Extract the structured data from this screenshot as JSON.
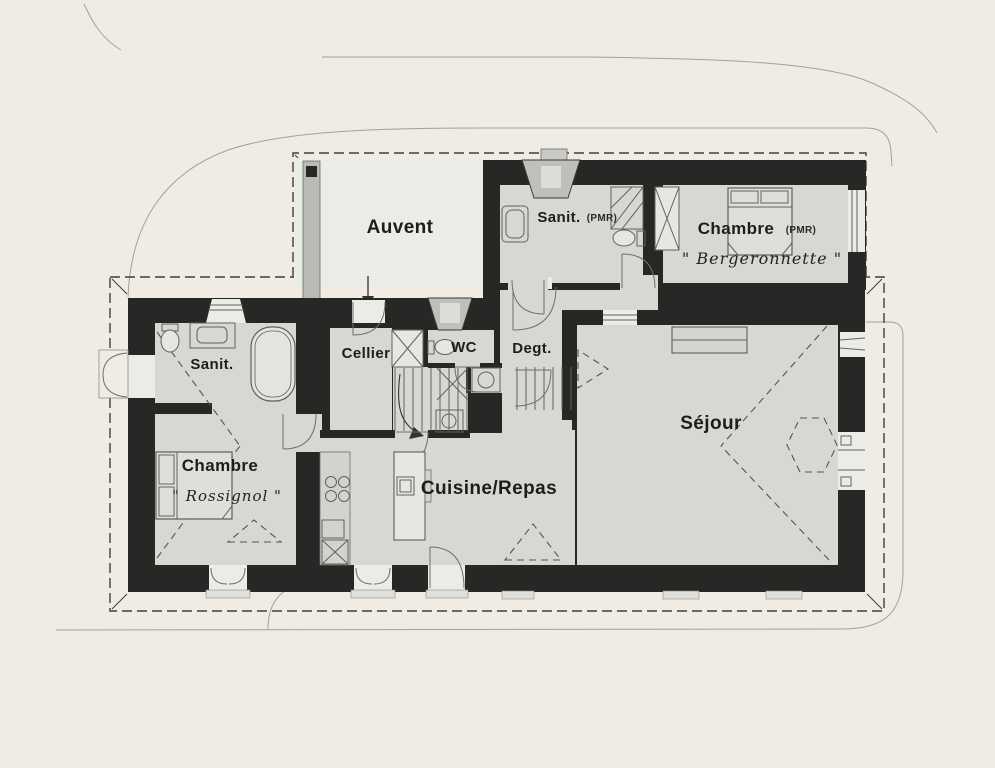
{
  "colors": {
    "bg": "#F0EBE3",
    "wall": "#272725",
    "floor": "#D7D7D4",
    "auvent_floor": "#ECECE6",
    "ink": "#1D1D1B",
    "line": "#61615D",
    "dash": "#3E3E3A",
    "ctx": "#A5A199",
    "roof": "#56544F"
  },
  "labels": {
    "auvent": "Auvent",
    "sanit_pmr": "Sanit.",
    "sanit_pmr_suffix": "(PMR)",
    "chambre_pmr": "Chambre",
    "chambre_pmr_suffix": "(PMR)",
    "chambre_pmr_name": "\" Bergeronnette \"",
    "sanit": "Sanit.",
    "cellier": "Cellier",
    "wc": "WC",
    "degt": "Degt.",
    "chambre": "Chambre",
    "chambre_name": "\" Rossignol \"",
    "cuisine": "Cuisine/Repas",
    "sejour": "Séjour"
  }
}
